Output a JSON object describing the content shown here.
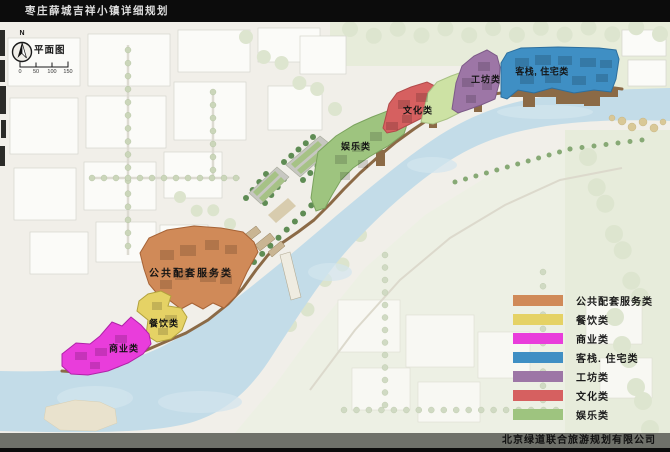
{
  "window": {
    "title": "枣庄薛城吉祥小镇详细规划",
    "company": "北京绿道联合旅游规划有限公司"
  },
  "map": {
    "plan_label": "平面图",
    "compass_north": "N",
    "scale_ticks": [
      "0",
      "50",
      "100",
      "150"
    ],
    "water_color": "#c3dce8",
    "zone_labels": {
      "public_service": "公共配套服务类",
      "catering": "餐饮类",
      "commercial": "商业类",
      "inn_residential": "客栈, 住宅类",
      "workshop": "工坊类",
      "culture": "文化类",
      "entertainment": "娱乐类"
    },
    "zone_colors": {
      "public_service": "#d08a58",
      "catering": "#e5d265",
      "commercial": "#e93ddb",
      "inn_residential": "#3f8fc4",
      "workshop": "#9d76a6",
      "culture": "#d66060",
      "entertainment": "#9ec47f",
      "green_strip": "#cde2a4"
    }
  },
  "legend": {
    "items": [
      {
        "label": "公共配套服务类",
        "color": "#d08a58"
      },
      {
        "label": "餐饮类",
        "color": "#e5d265"
      },
      {
        "label": "商业类",
        "color": "#e93ddb"
      },
      {
        "label": "客栈. 住宅类",
        "color": "#3f8fc4"
      },
      {
        "label": "工坊类",
        "color": "#9d76a6"
      },
      {
        "label": "文化类",
        "color": "#d66060"
      },
      {
        "label": "娱乐类",
        "color": "#9ec47f"
      }
    ]
  }
}
